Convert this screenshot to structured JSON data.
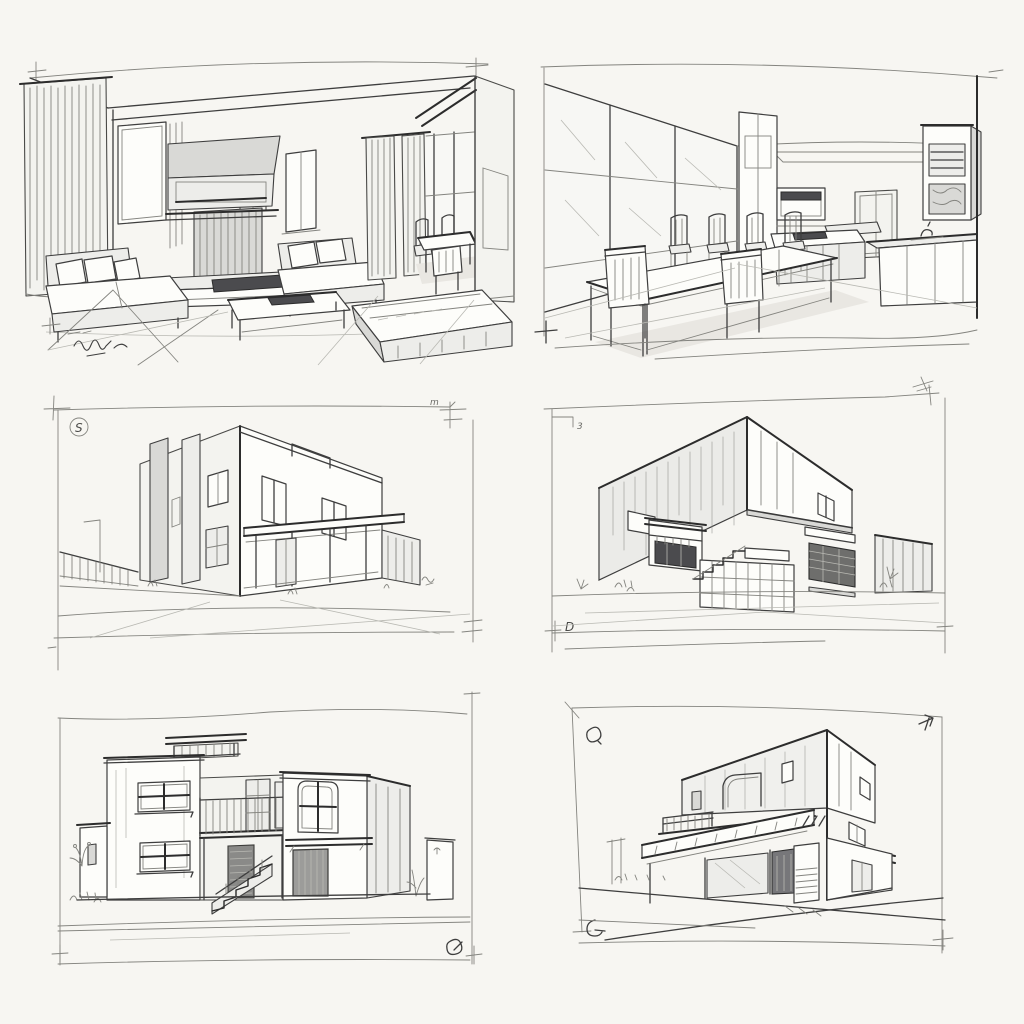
{
  "page": {
    "background": "#f7f6f2",
    "paper": "#fdfdfa",
    "ink": "#3e3e3e",
    "shade_light": "#ededea",
    "shade_mid": "#d9d9d6",
    "shade_dark": "#4b4b4e"
  },
  "grid": {
    "rows": 3,
    "cols": 2,
    "panel_count": 6
  },
  "panels": [
    {
      "id": "living-room-interior",
      "label": "Hand-drawn living room interior perspective sketch with sofas, wall unit, coffee table, daybed, curtains and dining nook",
      "marks": [
        "corner-tick",
        "artist-signature-scribble"
      ]
    },
    {
      "id": "dining-kitchen-interior",
      "label": "Hand-drawn dining room and kitchen perspective sketch with long table, chairs, island counter and tall cabinets",
      "marks": [
        "corner-tick-cross"
      ]
    },
    {
      "id": "modern-building-canopy",
      "label": "Two-storey modern flat-roof building sketch with entrance canopy, pilasters and fence",
      "annotations": {
        "circled_letter": "S",
        "corner_scribble": "m"
      }
    },
    {
      "id": "modern-cantilever-building",
      "label": "Modern cantilevered building sketch with entry stairs, balcony box and side walls",
      "annotations": {
        "top_left_note": "3",
        "bottom_left_note": "D"
      }
    },
    {
      "id": "house-external-stair",
      "label": "Two-storey flat-roof house sketch with external staircase, balcony, garage and clerestory roof",
      "marks": [
        "loop-scribble",
        "corner-tick-cross"
      ]
    },
    {
      "id": "corner-building-awning",
      "label": "Three-storey corner building sketch with wrap-around awning, terrace railing and storefronts",
      "marks": [
        "loop-scribble-top-left",
        "arrow-scribble-top-right",
        "loop-scribble-bottom-left",
        "corner-tick-cross"
      ]
    }
  ]
}
